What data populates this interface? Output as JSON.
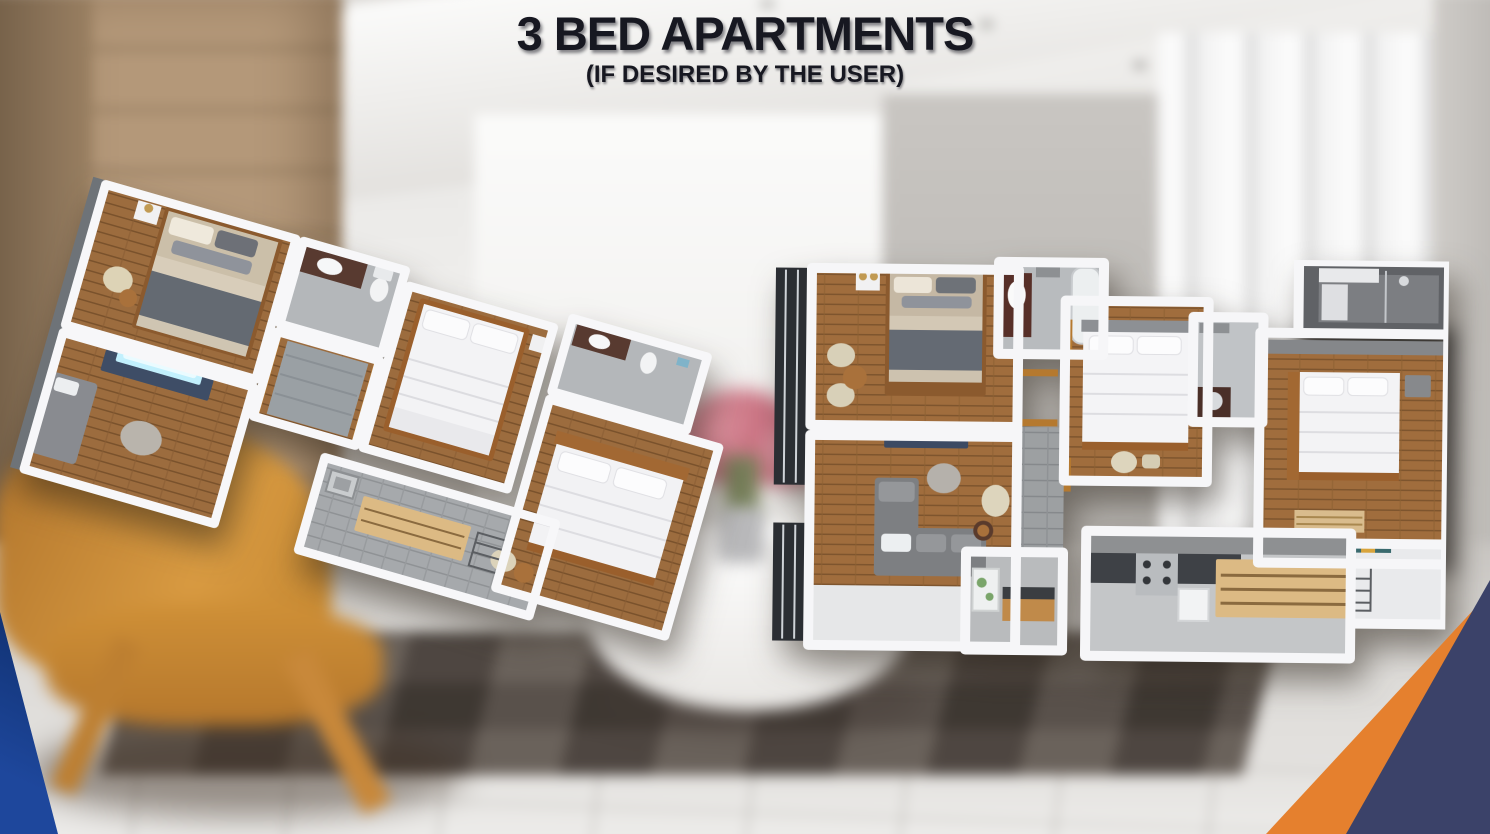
{
  "slide": {
    "title": "3 BED APARTMENTS",
    "subtitle": "(IF DESIRED BY THE USER)"
  },
  "colors": {
    "title_text": "#171821",
    "corner_blue_left": "#16387e",
    "corner_navy_right": "#3b4269",
    "corner_orange": "#e5802e"
  }
}
